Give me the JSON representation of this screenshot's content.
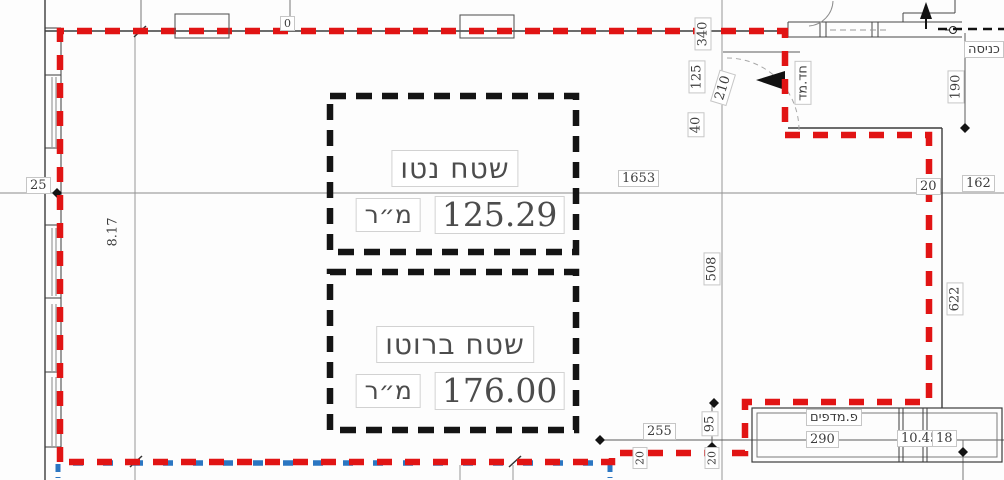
{
  "drawing": {
    "type": "architectural-floor-plan",
    "areas": {
      "net": {
        "label": "שטח נטו",
        "value": "125.29",
        "unit": "מ״ר"
      },
      "gross": {
        "label": "שטח ברוטו",
        "value": "176.00",
        "unit": "מ״ר"
      }
    },
    "rooms": {
      "entrance": "כניסה",
      "stairwell": "חד.מד",
      "shelves": "פ.מדפים"
    },
    "dims": {
      "left_offset": "25",
      "left_height": "8.17",
      "top_width": "1653",
      "right_gap": "20",
      "right_width": "162",
      "right_height_upper": "190",
      "right_height_lower": "622",
      "mid_height": "508",
      "notch_a": "340",
      "notch_b": "125",
      "notch_c": "40",
      "door_width": "210",
      "shelf_left": "255",
      "shelf_step": "95",
      "shelf_width": "290",
      "shelf_right_a": "10.45",
      "shelf_right_b": "18",
      "jog_a": "20",
      "jog_b": "20",
      "top_mark": "0"
    },
    "colors": {
      "boundary": "#e11414",
      "secondary": "#2b76c2",
      "area_box": "#141414"
    }
  }
}
